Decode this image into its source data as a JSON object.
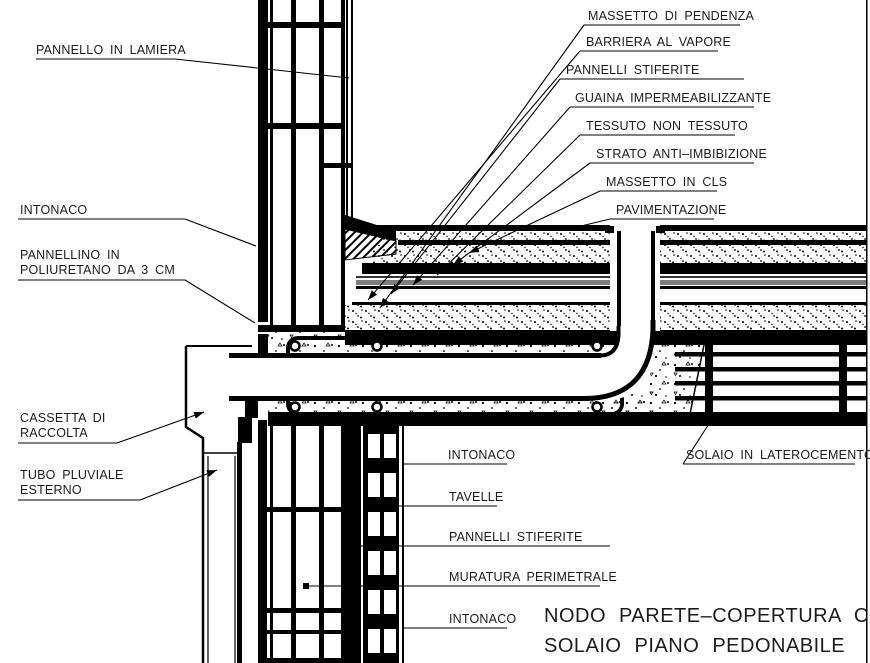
{
  "drawing_title": {
    "line1": "NODO PARETE–COPERTURA CON",
    "line2": "SOLAIO PIANO PEDONABILE"
  },
  "callouts": {
    "pannello_in_lamiera": "PANNELLO IN LAMIERA",
    "intonaco_esterno": "INTONACO",
    "pannellino_line1": "PANNELLINO IN",
    "pannellino_line2": "POLIURETANO DA 3 CM",
    "cassetta_line1": "CASSETTA DI",
    "cassetta_line2": "RACCOLTA",
    "tubo_line1": "TUBO PLUVIALE",
    "tubo_line2": "ESTERNO",
    "massetto_di_pendenza": "MASSETTO DI PENDENZA",
    "barriera_al_vapore": "BARRIERA AL VAPORE",
    "pannelli_stiferite_copertura": "PANNELLI STIFERITE",
    "guaina_impermeabilizzante": "GUAINA IMPERMEABILIZZANTE",
    "tessuto_non_tessuto": "TESSUTO NON TESSUTO",
    "strato_anti_imbibizione": "STRATO ANTI–IMBIBIZIONE",
    "massetto_in_cls": "MASSETTO IN CLS",
    "pavimentazione": "PAVIMENTAZIONE",
    "solaio_in_laterocemento": "SOLAIO IN LATEROCEMENTO",
    "intonaco_interno_alto": "INTONACO",
    "tavelle": "TAVELLE",
    "pannelli_stiferite_parete": "PANNELLI STIFERITE",
    "muratura_perimetrale": "MURATURA PERIMETRALE",
    "intonaco_interno_basso": "INTONACO"
  },
  "colors": {
    "line": "#000000",
    "background": "#ffffff",
    "guaina_gray": "#7d7d7d"
  }
}
